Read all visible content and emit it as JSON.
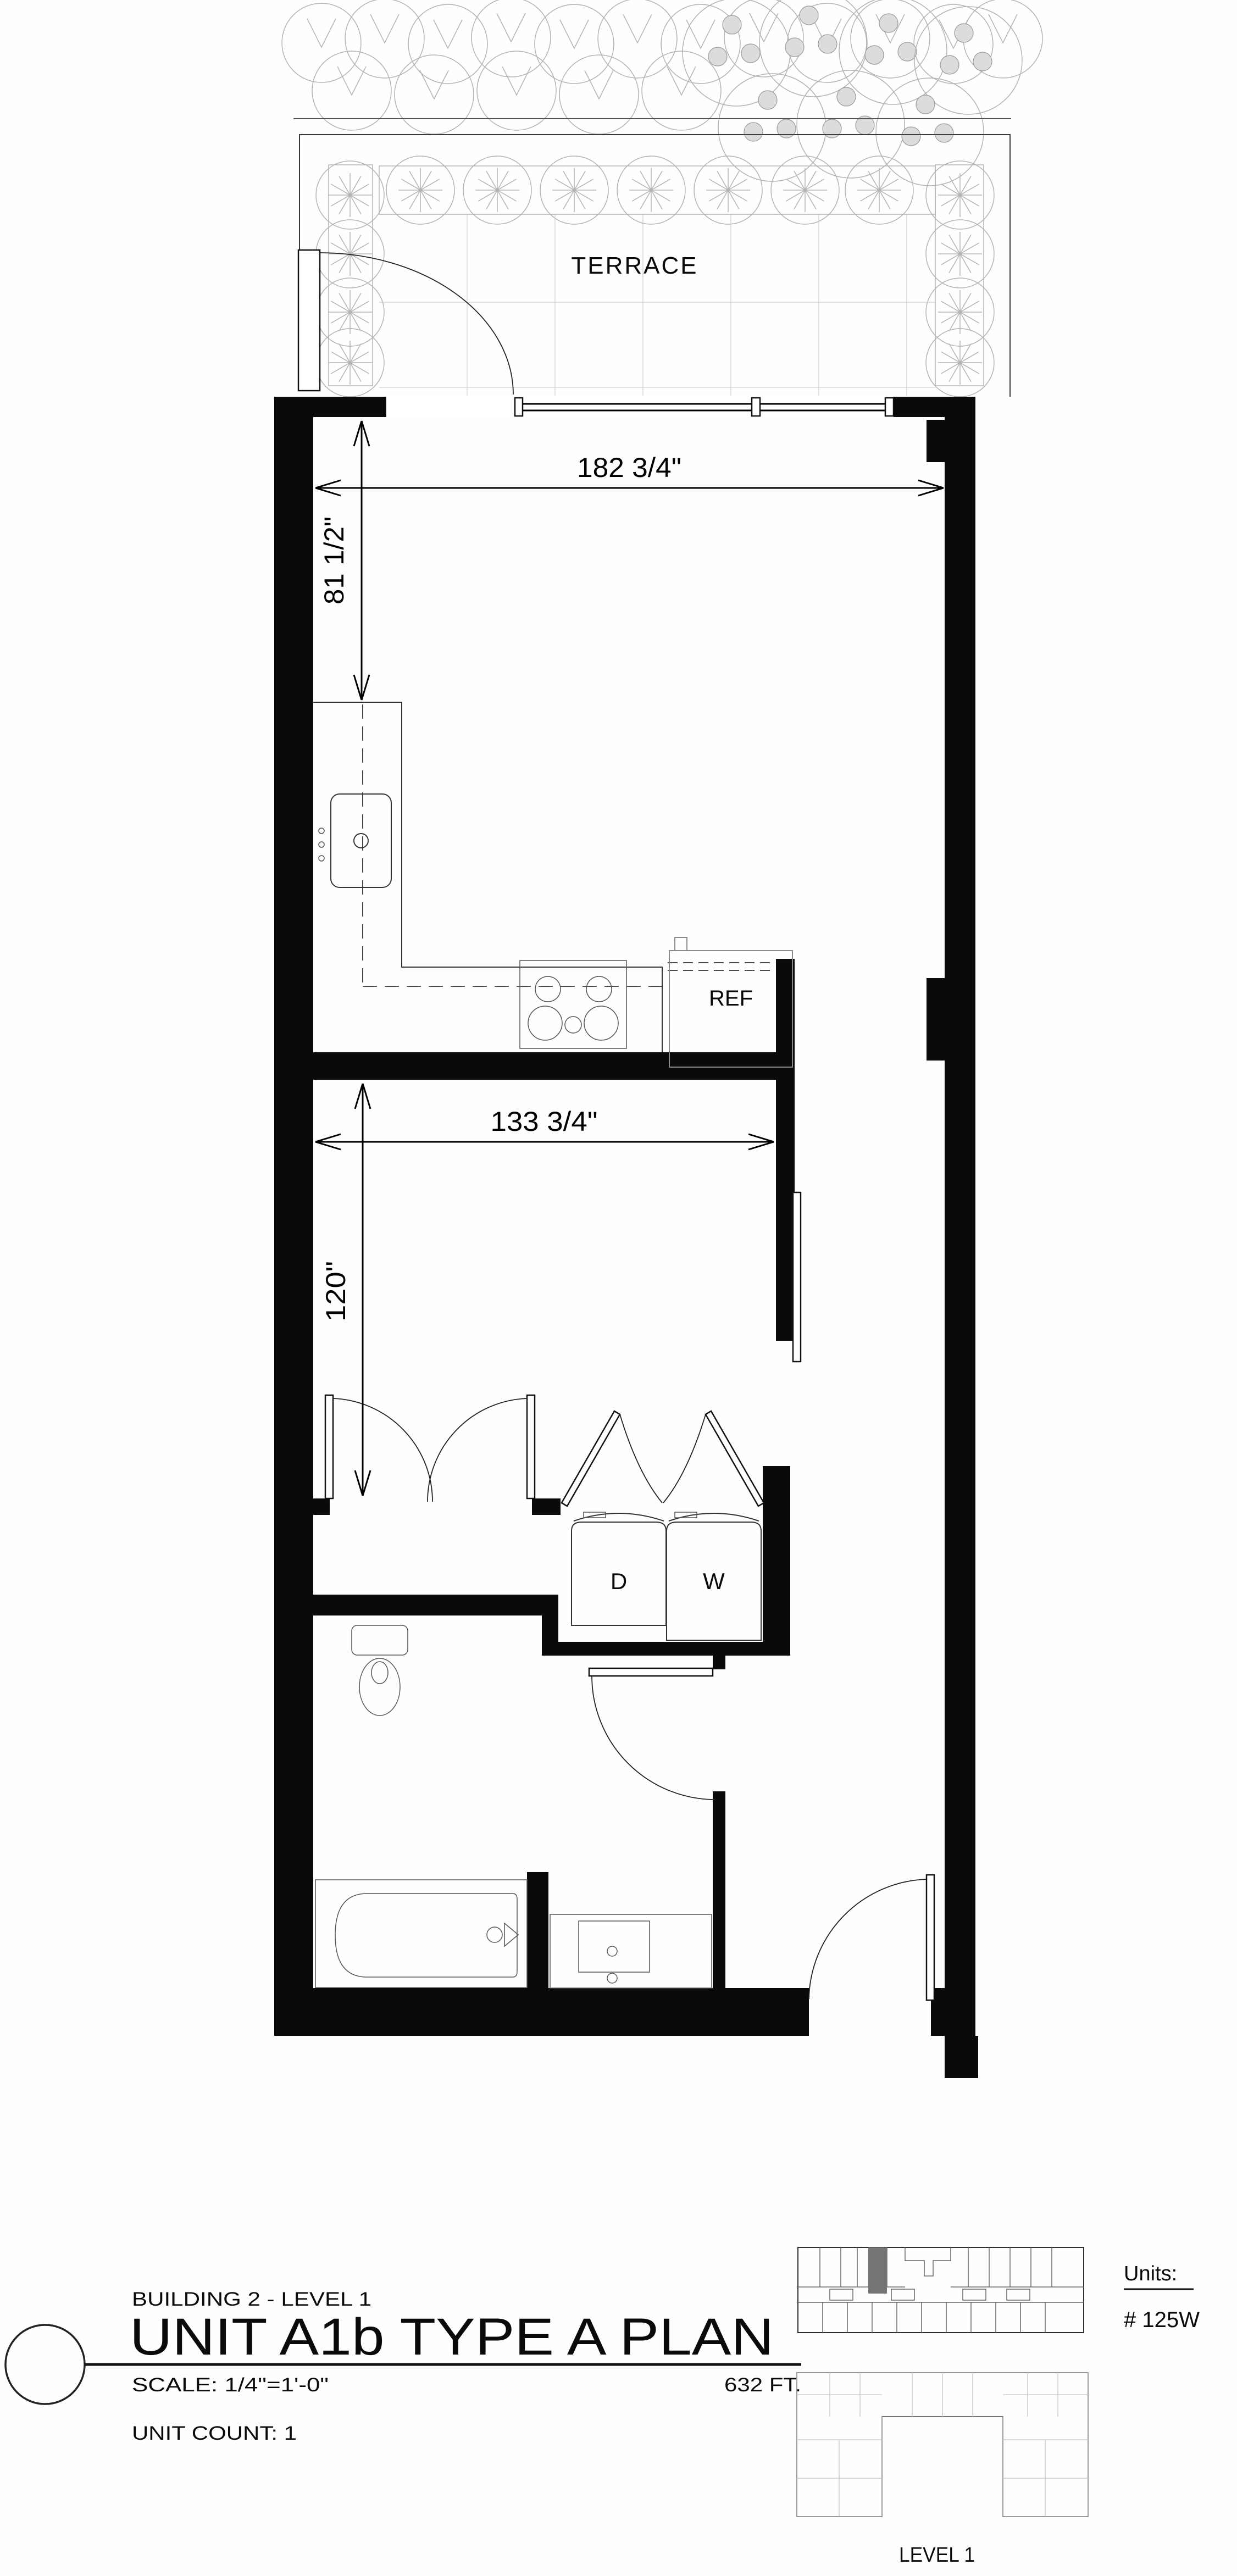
{
  "plan": {
    "terrace_label": "TERRACE",
    "ref_label": "REF",
    "dryer_label": "D",
    "washer_label": "W",
    "dim_overall_width": "182 3/4\"",
    "dim_kitchen_depth": "81 1/2\"",
    "dim_living_width": "133 3/4\"",
    "dim_living_depth": "120\""
  },
  "title_block": {
    "building": "BUILDING 2 - LEVEL 1",
    "unit_title": "UNIT A1b TYPE A PLAN",
    "scale": "SCALE:  1/4\"=1'-0\"",
    "area": "632 FT.",
    "unit_count": "UNIT COUNT: 1"
  },
  "key_plan": {
    "units_label": "Units:",
    "unit_number": "# 125W",
    "level_label": "LEVEL 1"
  },
  "colors": {
    "wall": "#0a0a0a",
    "landscape_line": "#b3b3b3",
    "highlight_unit": "#757575",
    "background": "#fefefe"
  }
}
